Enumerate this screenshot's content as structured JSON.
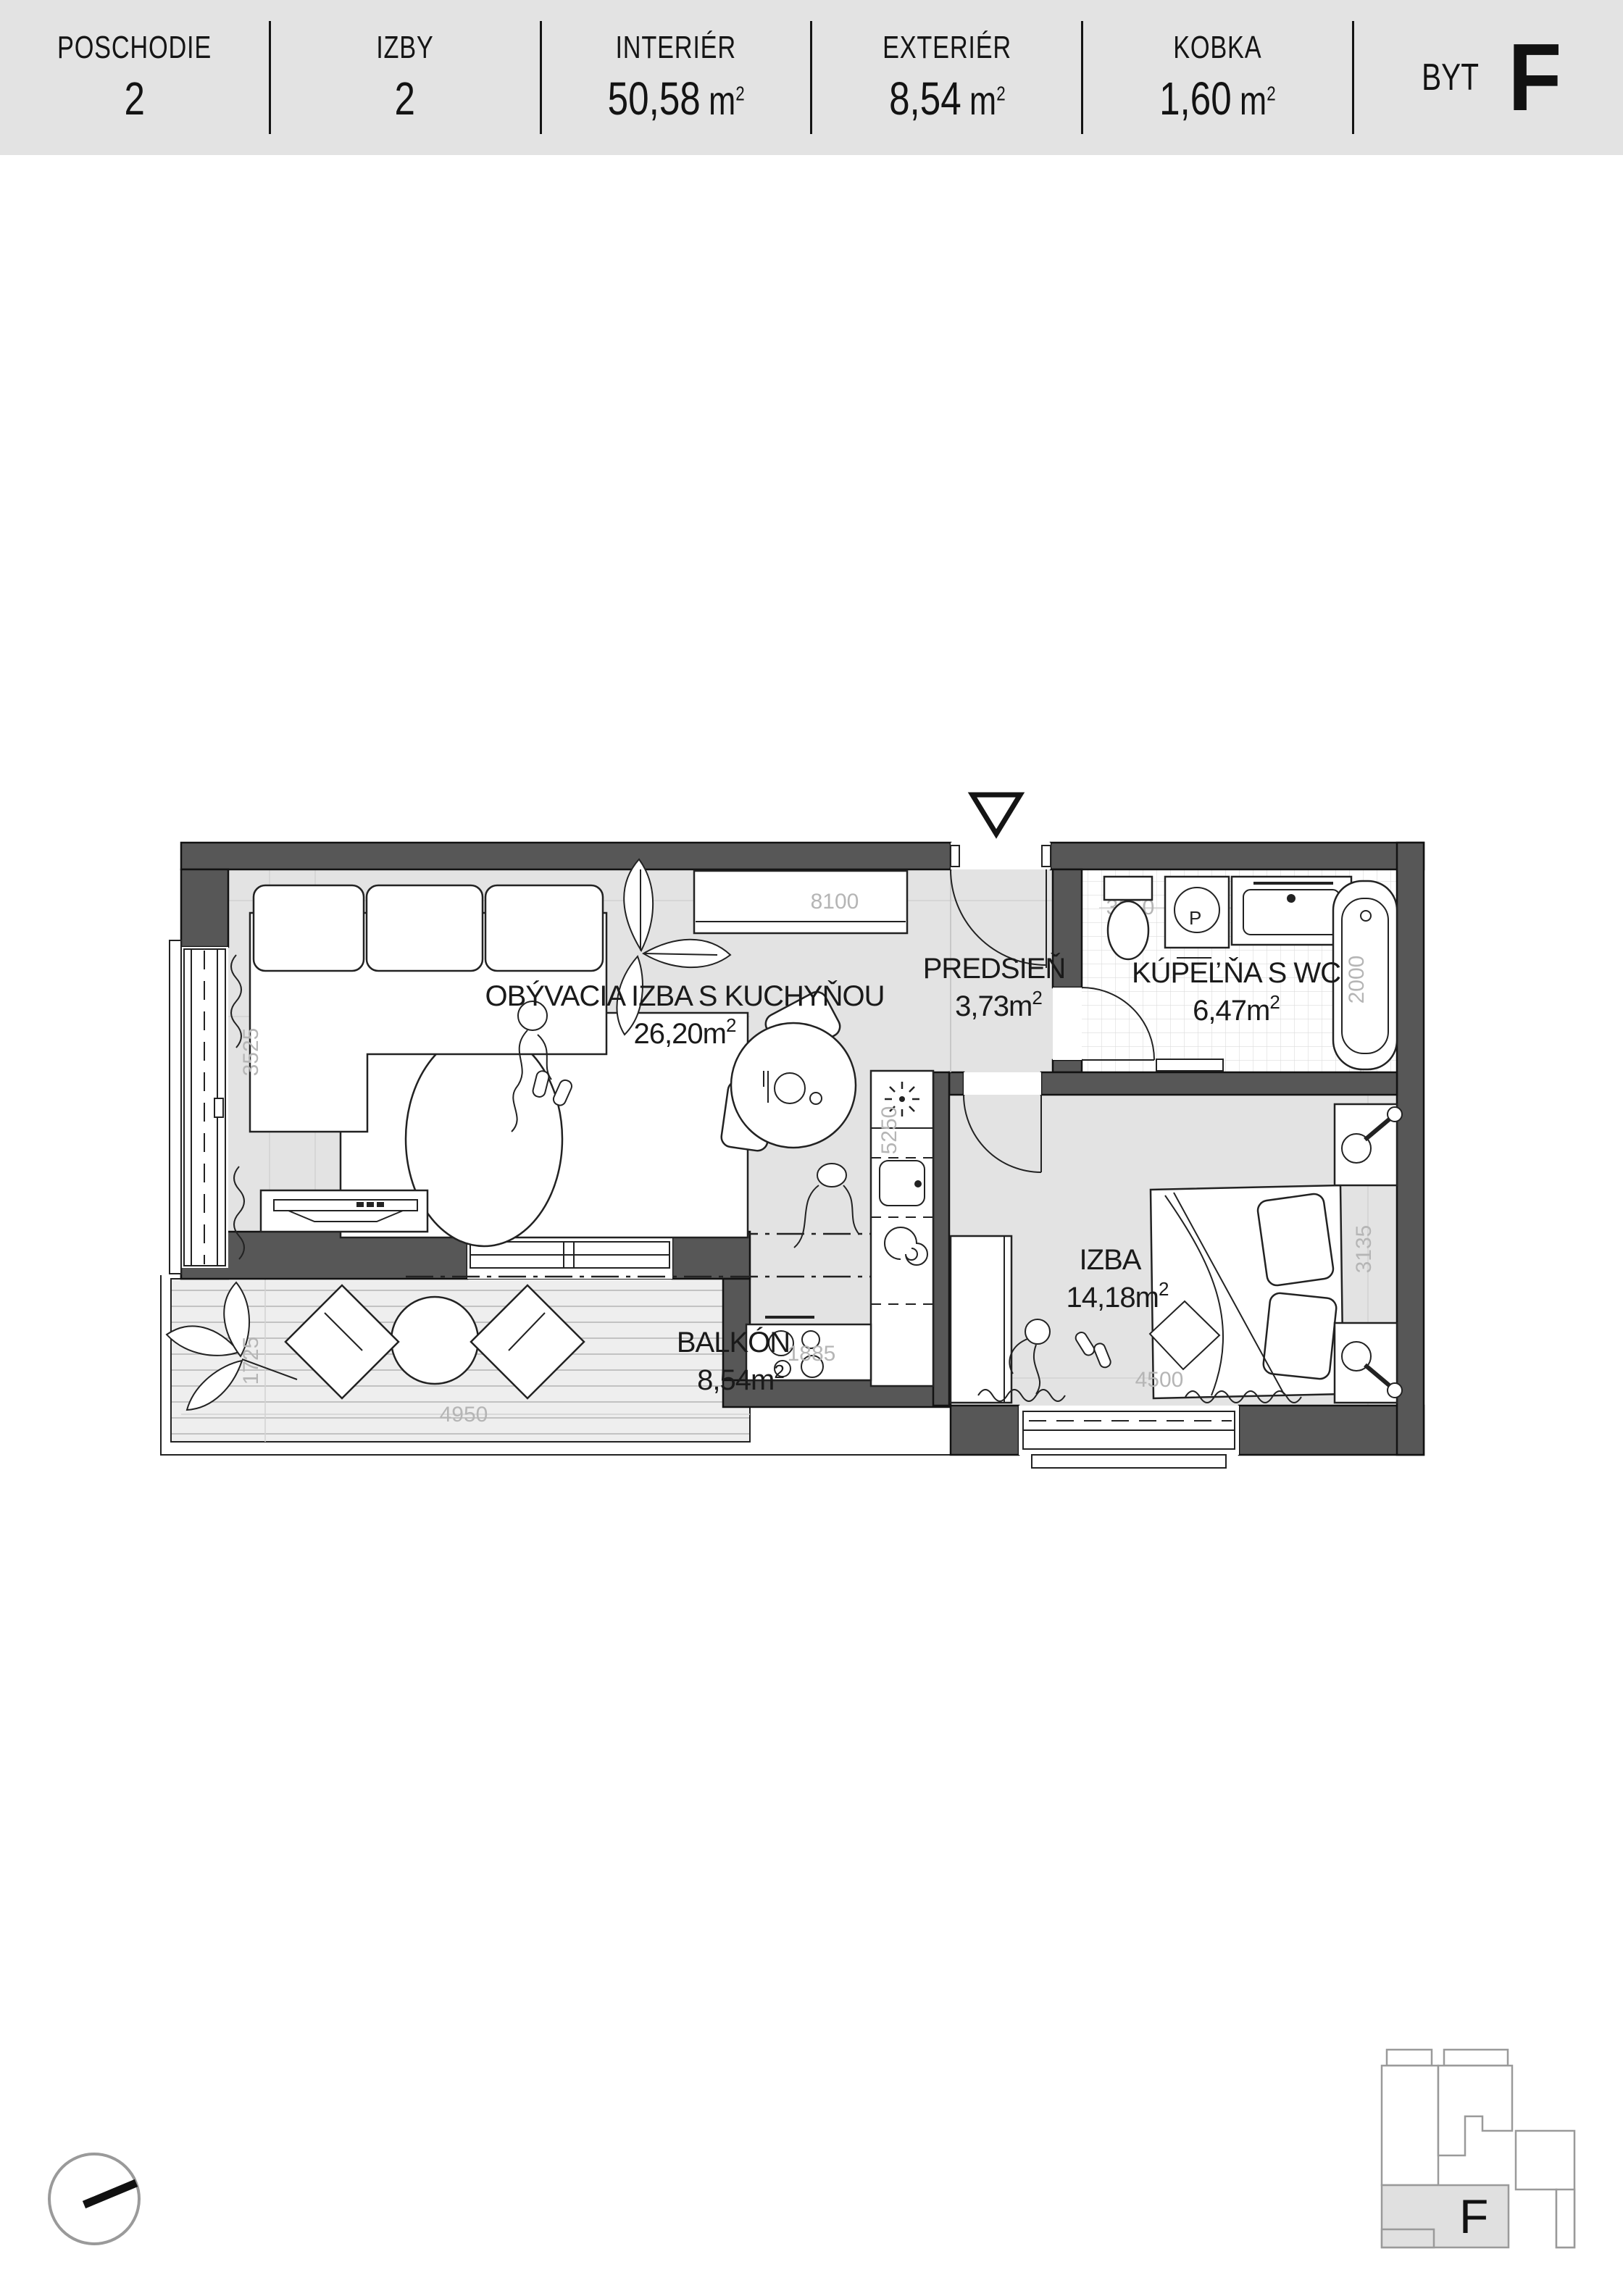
{
  "header": {
    "cells": [
      {
        "label": "POSCHODIE",
        "value": "2"
      },
      {
        "label": "IZBY",
        "value": "2"
      },
      {
        "label": "INTERIÉR",
        "value": "50,58",
        "unit": "m",
        "sup": "2"
      },
      {
        "label": "EXTERIÉR",
        "value": "8,54",
        "unit": "m",
        "sup": "2"
      },
      {
        "label": "KOBKA",
        "value": "1,60",
        "unit": "m",
        "sup": "2"
      }
    ],
    "unit_prefix": "BYT",
    "unit_letter": "F"
  },
  "plan": {
    "rooms": {
      "living": {
        "name": "OBÝVACIA IZBA S KUCHYŇOU",
        "area": "26,20m",
        "sup": "2"
      },
      "hall": {
        "name": "PREDSIEŇ",
        "area": "3,73m",
        "sup": "2"
      },
      "bath": {
        "name": "KÚPEĽŇA S WC",
        "area": "6,47m",
        "sup": "2"
      },
      "bedroom": {
        "name": "IZBA",
        "area": "14,18m",
        "sup": "2"
      },
      "balcony": {
        "name": "BALKÓN",
        "area": "8,54m",
        "sup": "2"
      }
    },
    "dims": {
      "living_top": "8100",
      "living_left": "3525",
      "balcony_left": "1725",
      "balcony_bottom": "4950",
      "kitchen_bottom": "1885",
      "kitchen_height": "5250",
      "bedroom_bottom": "4500",
      "bedroom_right": "3135",
      "bath_top": "3250",
      "bath_right": "2000"
    },
    "fixtures": {
      "washer_label": "P"
    }
  },
  "keyplan": {
    "letter": "F"
  }
}
